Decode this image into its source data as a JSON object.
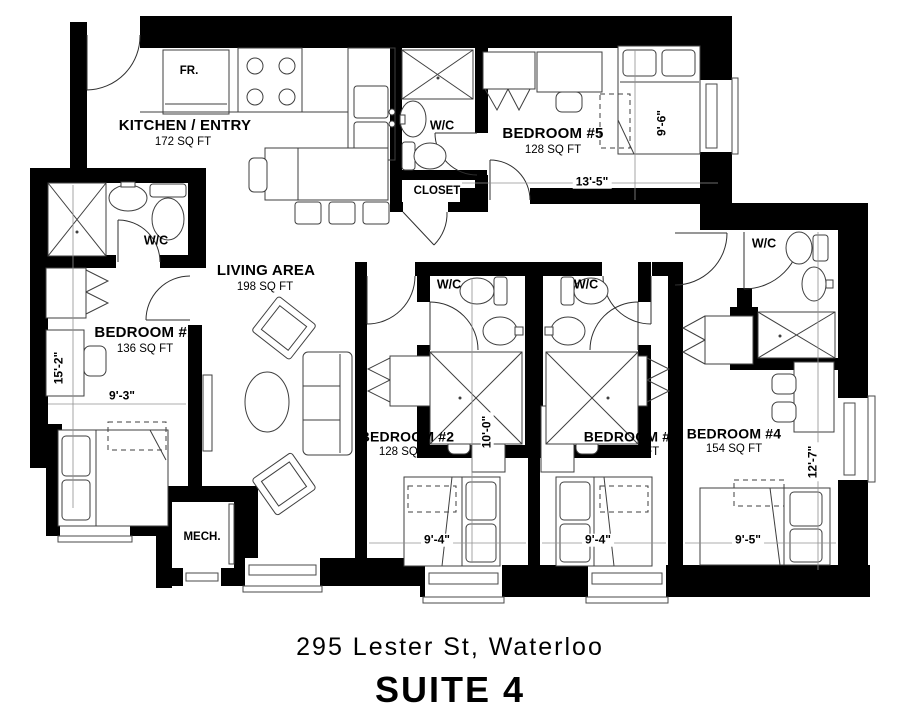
{
  "title": {
    "address": "295 Lester St, Waterloo",
    "suite": "SUITE 4"
  },
  "rooms": {
    "kitchen": {
      "name": "KITCHEN / ENTRY",
      "area": "172 SQ FT"
    },
    "living": {
      "name": "LIVING AREA",
      "area": "198 SQ FT"
    },
    "bedroom1": {
      "name": "BEDROOM #1",
      "area": "136 SQ FT"
    },
    "bedroom2": {
      "name": "BEDROOM #2",
      "area": "128 SQ FT"
    },
    "bedroom3": {
      "name": "BEDROOM #3",
      "area": "124 SQ FT"
    },
    "bedroom4": {
      "name": "BEDROOM #4",
      "area": "154 SQ FT"
    },
    "bedroom5": {
      "name": "BEDROOM #5",
      "area": "128 SQ FT"
    },
    "closet": {
      "name": "CLOSET"
    },
    "mech": {
      "name": "MECH."
    }
  },
  "fixtures": {
    "wc": "W/C",
    "fridge": "FR."
  },
  "dims": {
    "bedroom1_height": "15'-2\"",
    "bedroom1_width": "9'-3\"",
    "bedroom5_width": "13'-5\"",
    "bedroom5_height": "9'-6\"",
    "bedroom2_height": "10'-0\"",
    "bedroom2_width": "9'-4\"",
    "bedroom3_width": "9'-4\"",
    "bedroom4_width": "9'-5\"",
    "bedroom4_height": "12'-7\""
  },
  "colors": {
    "wall": "#000000",
    "background": "#ffffff",
    "line": "#3f3f3f"
  }
}
